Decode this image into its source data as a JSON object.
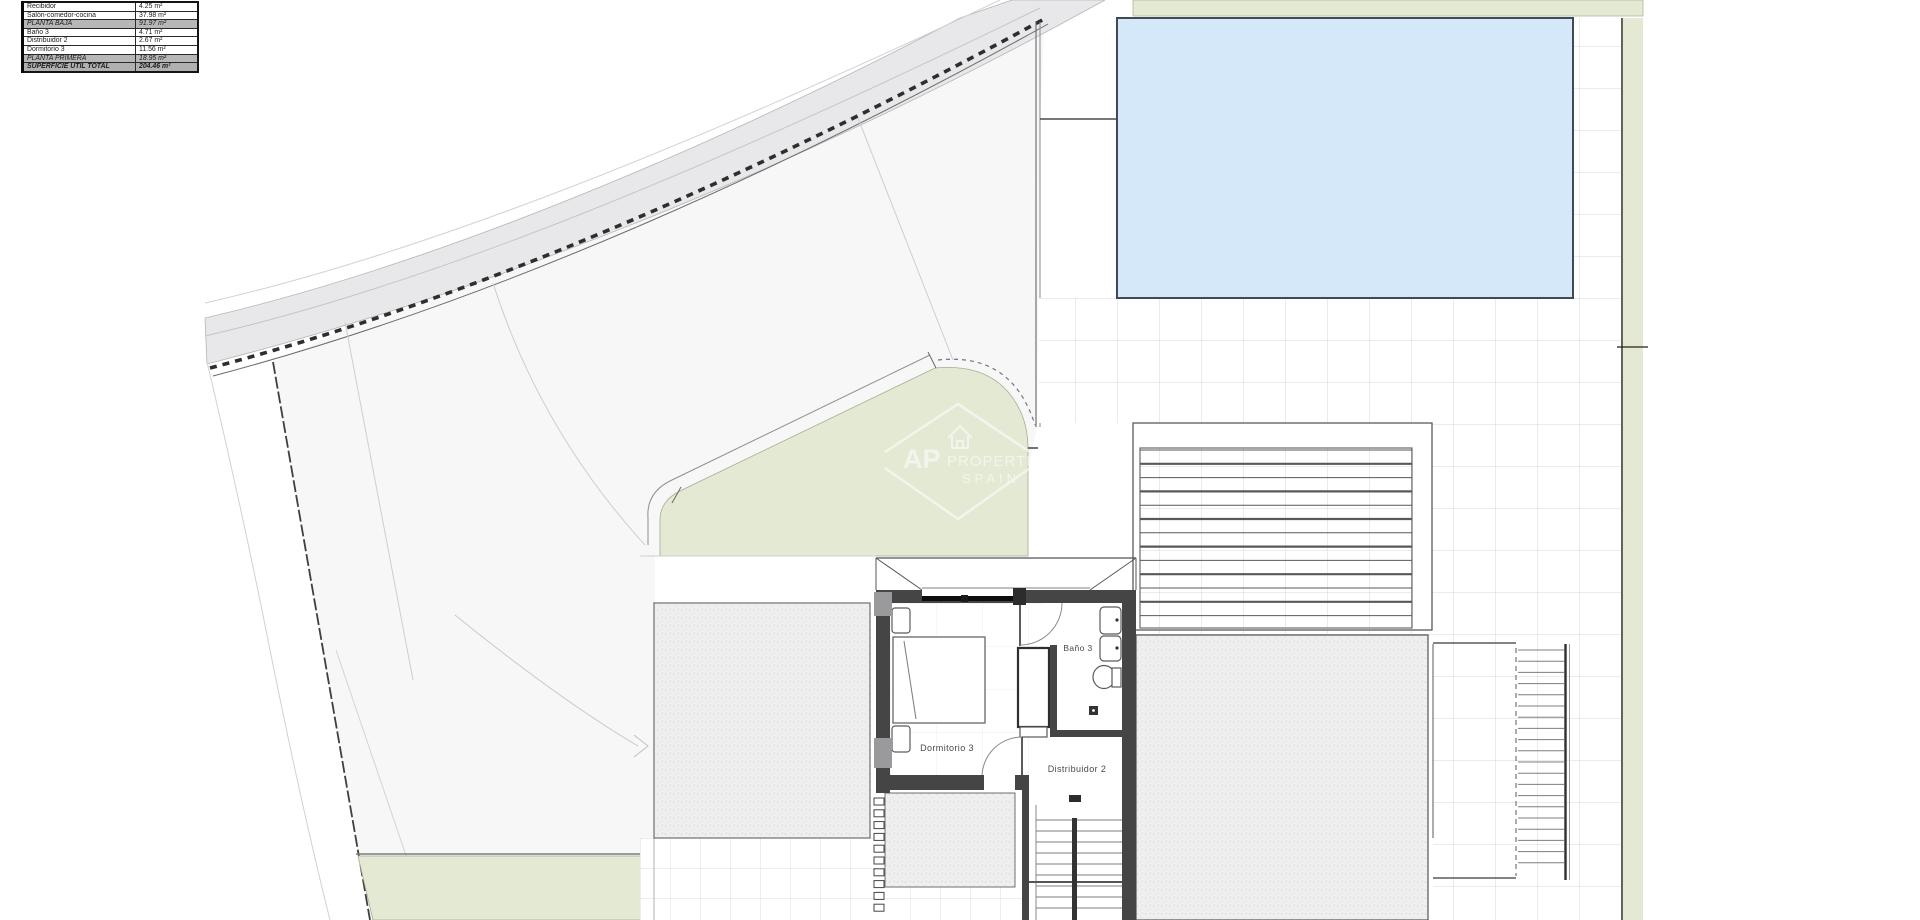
{
  "legend": {
    "rows": [
      {
        "label": "Recibidor",
        "value": "4.25 m²"
      },
      {
        "label": "Salón-comedor-cocina",
        "value": "37.98 m²"
      },
      {
        "label": "PLANTA BAJA",
        "value": "91.97 m²"
      },
      {
        "label": "Baño 3",
        "value": "4.71 m²"
      },
      {
        "label": "Distribuidor 2",
        "value": "2.67 m²"
      },
      {
        "label": "Dormitorio 3",
        "value": "11.56 m²"
      },
      {
        "label": "PLANTA PRIMERA",
        "value": "18.95 m²"
      },
      {
        "label": "SUPERFICIE ÚTIL TOTAL",
        "value": "204.46 m²"
      }
    ]
  },
  "plan_labels": {
    "bedroom": "Dormitorio 3",
    "bathroom": "Baño 3",
    "hall": "Distribuidor 2"
  },
  "watermark": {
    "brand": "AP",
    "brand2": "PROPERTIES",
    "brand3": "SPAIN"
  },
  "colors": {
    "grass": "#e3e9d3",
    "pool_water": "#d5e8fa",
    "road": "#e8e8ea",
    "wall": "#454545",
    "plot": "#f7f7f8"
  }
}
